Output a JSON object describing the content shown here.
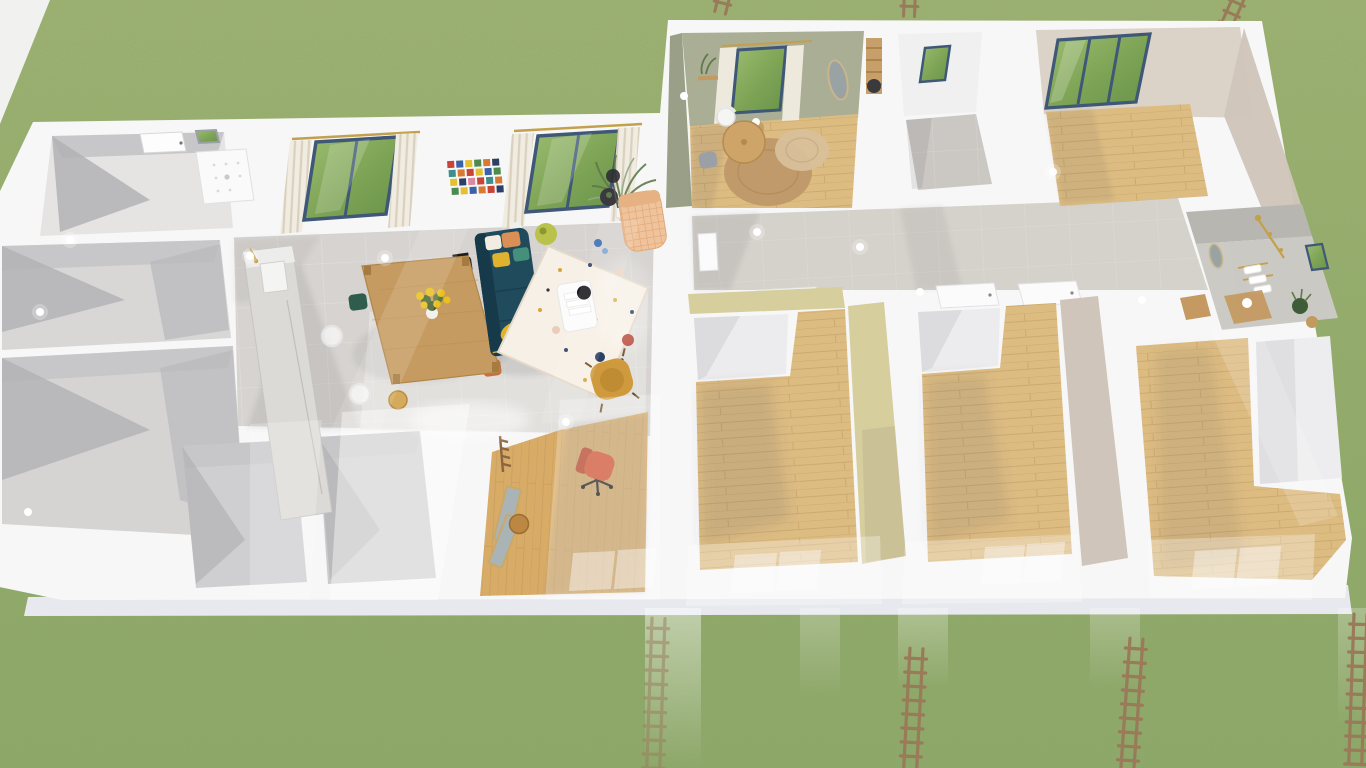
{
  "scene": {
    "title": "3D aerial rendering of a single-storey house floor plan on a fenced grass lot",
    "view": "top-down oblique perspective",
    "environment": {
      "ground": "lawn grass",
      "paved_corner": "top-left",
      "walkway": "light concrete strip along bottom facade",
      "fences_top": 3,
      "fences_bottom": 4,
      "light_streaks": 4,
      "ceiling_lights": 12
    }
  },
  "colors": {
    "grass": "#93ab68",
    "grass-light": "#9fb273",
    "grass-dark": "#89a463",
    "pavement": "#f1f1ef",
    "slab": "#f7f7f8",
    "walkway": "#e7e9ee",
    "wall-shade-1": "#c7c7c9",
    "wall-shade-2": "#b2b2b5",
    "tile": "#d6d3d0",
    "tile-light": "#e6e4e2",
    "tile-dim": "#cbc8c4",
    "wood": "#ddbc82",
    "wood-dark": "#b2905a",
    "wood-office": "#d8ab67",
    "sage": "#a9ae95",
    "sage-dark": "#99a087",
    "beige-wall": "#dbd2c8",
    "beige-wall-dark": "#cfc5ba",
    "khaki": "#d7ce9e",
    "khaki-dark": "#c9bf8d",
    "concrete": "#b8b6b1",
    "concrete-light": "#cccac5",
    "counter": "#dbdad7",
    "window-frame": "#3f5877",
    "glass-green": "#7da355",
    "curtain": "#f0ebe0",
    "curtain-stripe": "#d8cfbd",
    "gold": "#c3a04b",
    "sofa": "#204b5d",
    "sofa-dark": "#163a4a",
    "cushion-yellow": "#e0b32f",
    "cushion-orange": "#d98f55",
    "cushion-green": "#44907a",
    "rug-cream": "#f7f0e6",
    "rug-navy": "#2e3f63",
    "rug-red": "#b33f2f",
    "rug-gold": "#d8a43c",
    "rug-blush": "#e9cdb9",
    "armchair": "#cf9a3d",
    "chaise": "#efc49c",
    "chaise-pattern": "#dd9a66",
    "dining-wood": "#c69b61",
    "chair-black": "#303032",
    "chair-white": "#fafafa",
    "chair-orange": "#c96e3c",
    "chair-green": "#2f5c4d",
    "office-chair": "#cf5132",
    "jute": "#c09a6a",
    "jute-light": "#d8c09a",
    "mirror-glass": "#aab3b6",
    "fence": "#997a59",
    "plant-green": "#5d7a4a",
    "plant-dark": "#3f5c38",
    "sunflower": "#e8c020",
    "vase-green": "#b9c24a"
  },
  "rooms": [
    {
      "name": "utility-room",
      "floor": "grey tile",
      "contents": [
        "entry-door",
        "shower-tray",
        "small-window"
      ]
    },
    {
      "name": "storage-room-upper",
      "floor": "bare concrete",
      "contents": []
    },
    {
      "name": "storage-room-lower",
      "floor": "bare concrete",
      "contents": []
    },
    {
      "name": "closet-a",
      "floor": "bare concrete",
      "contents": []
    },
    {
      "name": "closet-b",
      "floor": "bare concrete",
      "contents": []
    },
    {
      "name": "living-dining-kitchen",
      "floor": "grey tile",
      "walls": "white",
      "contents": [
        "kitchen-counter-with-sink",
        "dining-table",
        "sunflower-bouquet",
        "dining-chairs",
        "teal-sofa",
        "terrazzo-rug",
        "coffee-table",
        "mustard-armchair",
        "patterned-chaise",
        "side-table",
        "floor-lamp",
        "potted-plant",
        "green-vase",
        "mosaic-wall-art",
        "curtained-window",
        "curtained-window"
      ]
    },
    {
      "name": "home-office",
      "floor": "light wood",
      "contents": [
        "desk-chair",
        "leaning-mirror",
        "leaning-mirror",
        "stool",
        "coat-rack",
        "ghost-window"
      ]
    },
    {
      "name": "study",
      "floor": "light wood",
      "walls": "sage green",
      "contents": [
        "curtained-window",
        "round-table",
        "shell-chair",
        "grey-chair",
        "jute-rug",
        "jute-rug-small",
        "oval-mirror",
        "wall-shelf-with-plant",
        "ladder-shelf",
        "floor-lamp"
      ]
    },
    {
      "name": "wc",
      "floor": "grey tile",
      "contents": [
        "small-window"
      ]
    },
    {
      "name": "hallway",
      "floor": "grey tile",
      "contents": [
        "door",
        "door",
        "door",
        "door",
        "wood-door"
      ]
    },
    {
      "name": "bedroom-1",
      "floor": "light wood",
      "walls": "warm beige",
      "contents": [
        "large-window"
      ]
    },
    {
      "name": "bathroom",
      "floor": "grey tile",
      "walls": "polished concrete",
      "contents": [
        "gold-shower-set",
        "towel-rack",
        "white-towels",
        "wood-vanity",
        "oval-mirror",
        "potted-plant",
        "basket",
        "small-window"
      ]
    },
    {
      "name": "bedroom-2",
      "floor": "light wood",
      "accent_wall": "khaki",
      "contents": [
        "closet-nook",
        "ghost-window"
      ]
    },
    {
      "name": "bedroom-3",
      "floor": "light wood",
      "accent_wall": "khaki",
      "contents": [
        "closet-nook",
        "ghost-window"
      ]
    },
    {
      "name": "bedroom-4",
      "floor": "light wood",
      "accent_wall": "beige",
      "contents": [
        "closet",
        "ghost-window"
      ]
    }
  ]
}
